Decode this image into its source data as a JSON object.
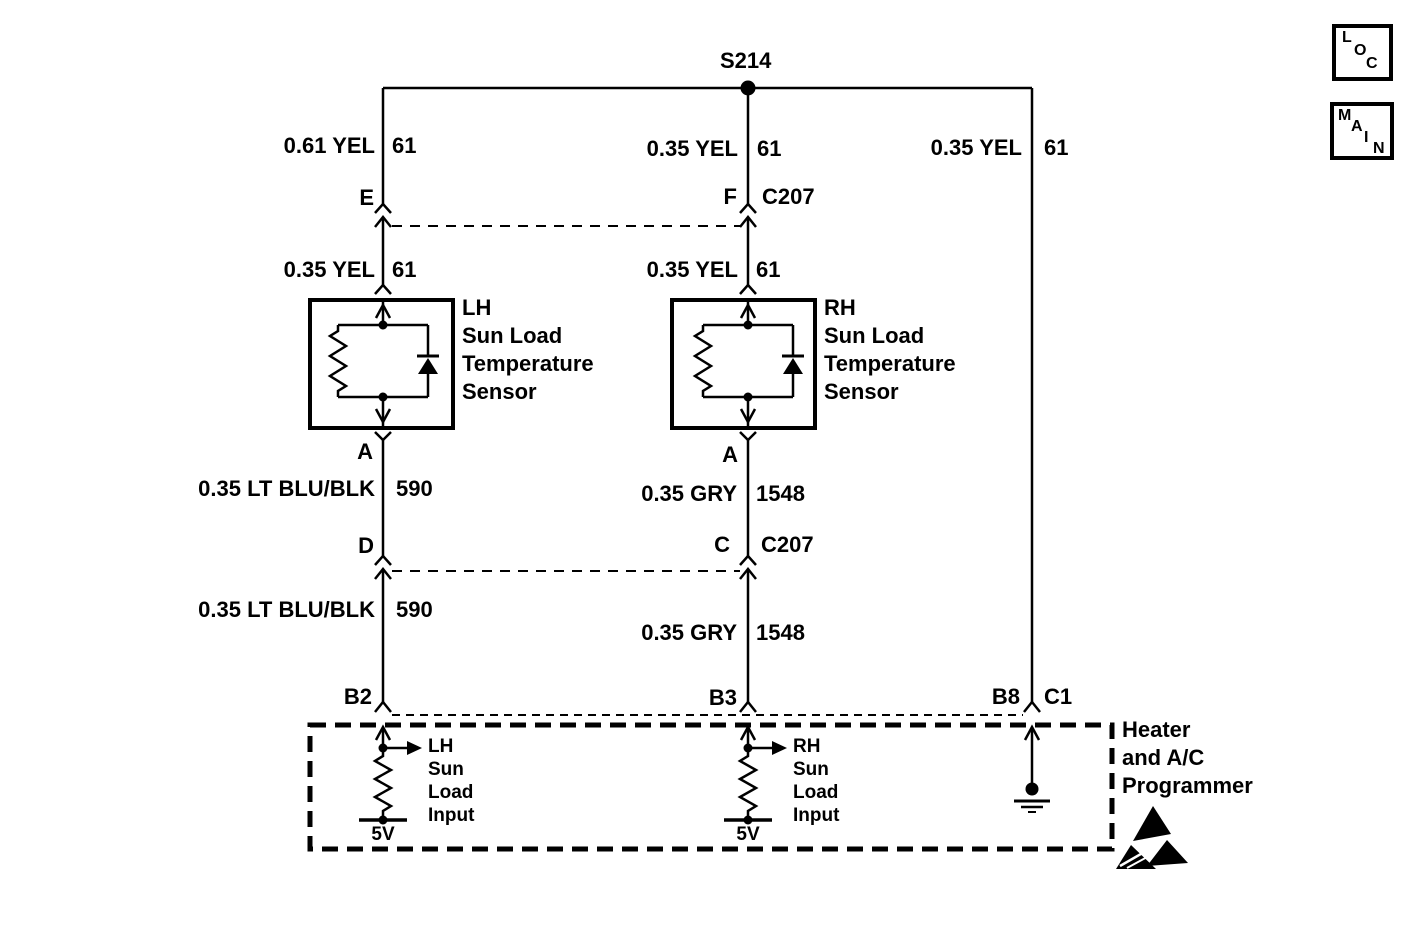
{
  "diagram": {
    "splice_label": "S214",
    "colors": {
      "line": "#000000",
      "background": "#ffffff"
    }
  },
  "corner_boxes": {
    "loc": {
      "letters": [
        "L",
        "O",
        "C"
      ]
    },
    "main": {
      "letters": [
        "M",
        "A",
        "I",
        "N"
      ]
    }
  },
  "wire_labels": {
    "top_left": {
      "spec": "0.61 YEL",
      "circuit": "61"
    },
    "top_center": {
      "spec": "0.35 YEL",
      "circuit": "61"
    },
    "top_right": {
      "spec": "0.35 YEL",
      "circuit": "61"
    },
    "mid_left": {
      "spec": "0.35 YEL",
      "circuit": "61"
    },
    "mid_center": {
      "spec": "0.35 YEL",
      "circuit": "61"
    },
    "low_left_upper": {
      "spec": "0.35 LT BLU/BLK",
      "circuit": "590"
    },
    "low_right_upper": {
      "spec": "0.35 GRY",
      "circuit": "1548"
    },
    "low_left_lower": {
      "spec": "0.35 LT BLU/BLK",
      "circuit": "590"
    },
    "low_right_lower": {
      "spec": "0.35 GRY",
      "circuit": "1548"
    }
  },
  "connectors": {
    "e": {
      "pin": "E"
    },
    "f": {
      "pin": "F",
      "name": "C207"
    },
    "a_lh": {
      "pin": "A"
    },
    "a_rh": {
      "pin": "A"
    },
    "d": {
      "pin": "D"
    },
    "c": {
      "pin": "C",
      "name": "C207"
    },
    "b2": {
      "pin": "B2"
    },
    "b3": {
      "pin": "B3"
    },
    "b8": {
      "pin": "B8",
      "name": "C1"
    }
  },
  "sensors": {
    "lh": {
      "lines": [
        "LH",
        "Sun Load",
        "Temperature",
        "Sensor"
      ]
    },
    "rh": {
      "lines": [
        "RH",
        "Sun Load",
        "Temperature",
        "Sensor"
      ]
    }
  },
  "programmer": {
    "label_lines": [
      "Heater",
      "and A/C",
      "Programmer"
    ],
    "lh_input": {
      "lines": [
        "LH",
        "Sun",
        "Load",
        "Input"
      ],
      "voltage": "5V"
    },
    "rh_input": {
      "lines": [
        "RH",
        "Sun",
        "Load",
        "Input"
      ],
      "voltage": "5V"
    }
  }
}
